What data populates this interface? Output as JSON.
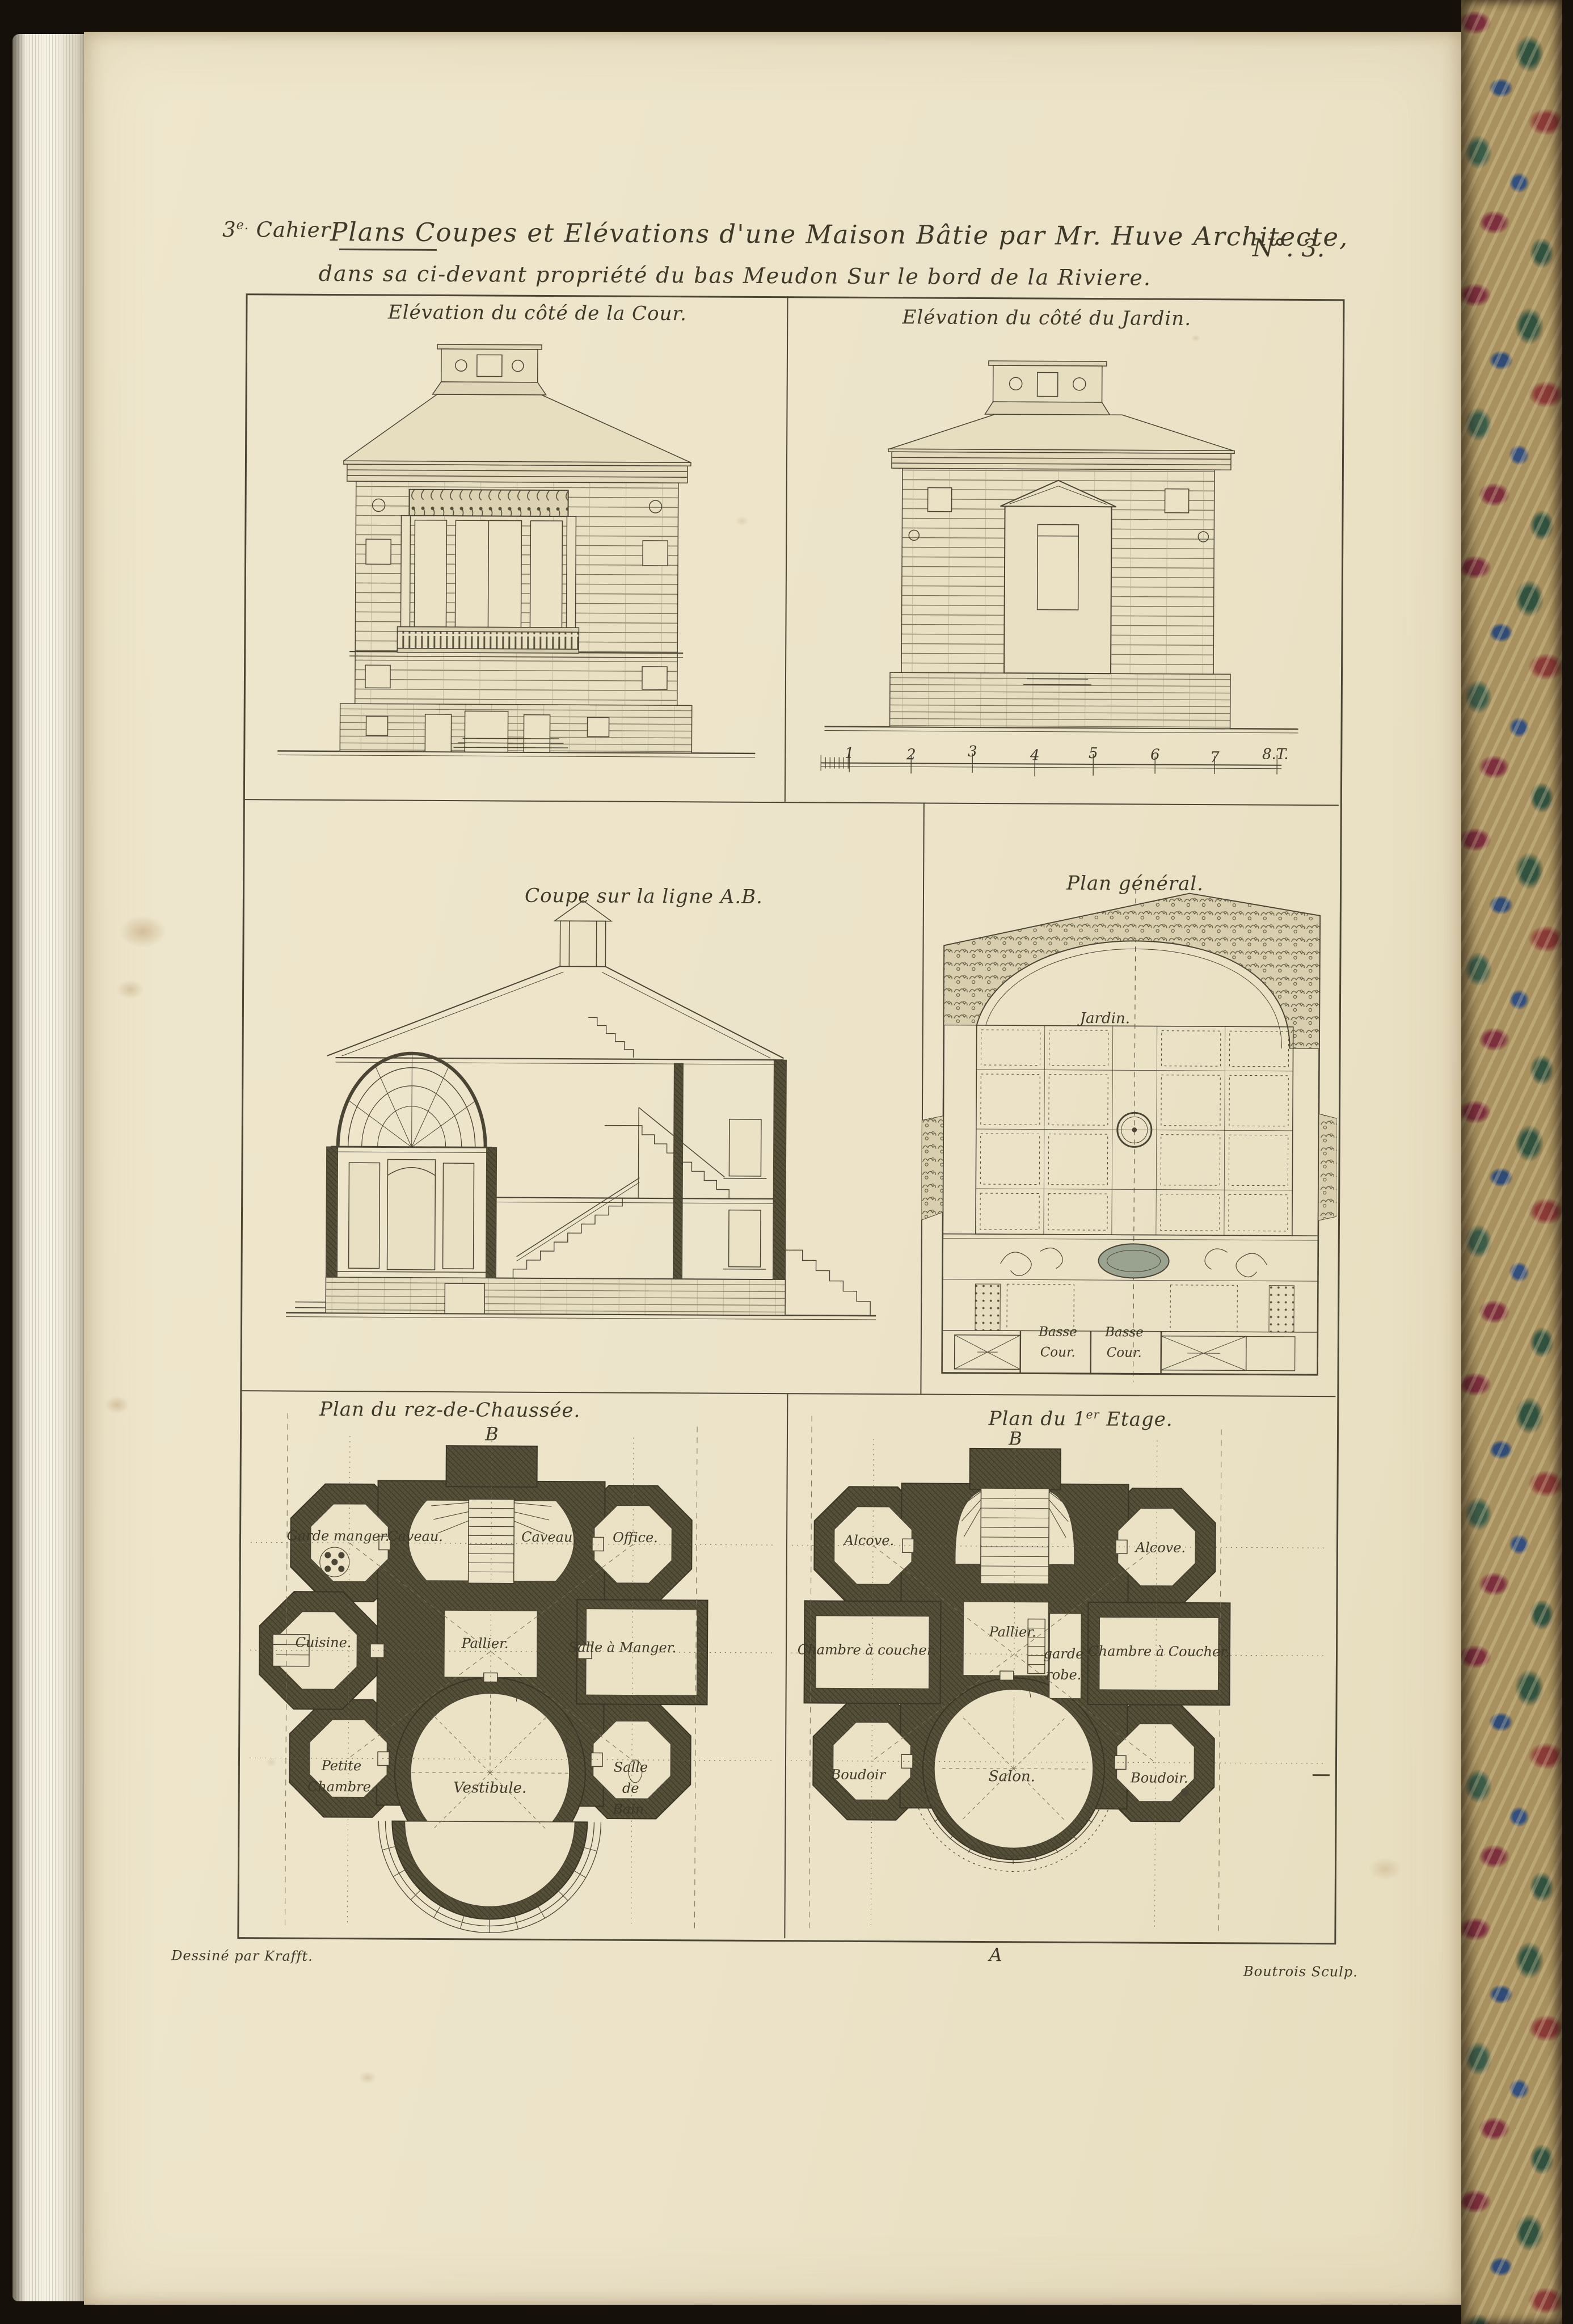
{
  "plate": {
    "header": {
      "cahier_number": "3",
      "cahier_sup": "e.",
      "cahier_word": "Cahier",
      "title_line1": "Plans Coupes et Elévations d'une Maison Bâtie par Mr. Huve Architecte,",
      "title_line2": "dans sa ci-devant propriété du bas Meudon Sur le bord de la Riviere.",
      "plate_number": "N°. 3."
    },
    "panels": {
      "elevation_cour": {
        "title": "Elévation du côté de la Cour."
      },
      "elevation_jardin": {
        "title": "Elévation du côté du Jardin.",
        "scale_ticks": [
          "1",
          "2",
          "3",
          "4",
          "5",
          "6",
          "7",
          "8.T."
        ]
      },
      "coupe": {
        "title": "Coupe sur la ligne A.B."
      },
      "plan_general": {
        "title": "Plan général.",
        "labels": {
          "garden": "Jardin.",
          "basse_cour_left": "Basse Cour.",
          "basse_cour_right": "Basse Cour."
        }
      },
      "plan_rdc": {
        "title": "Plan du rez-de-Chaussée.",
        "marker_top": "B",
        "rooms": {
          "garde_manger": "Garde manger.",
          "caveau_left": "Caveau.",
          "caveau_right": "Caveau.",
          "office": "Office.",
          "cuisine": "Cuisine.",
          "pallier": "Pallier.",
          "salle_a_manger": "Salle à Manger.",
          "petite_chambre": "Petite Chambre.",
          "vestibule": "Vestibule.",
          "salle_de_bain": "Salle de Bain."
        }
      },
      "plan_etage": {
        "title_prefix": "Plan du 1",
        "title_sup": "er",
        "title_suffix": " Etage.",
        "marker_top": "B",
        "marker_bottom": "A",
        "rooms": {
          "alcove_left": "Alcove.",
          "alcove_right": "Alcove.",
          "pallier": "Pallier.",
          "chambre_left": "Chambre à coucher.",
          "garde_robe": "garde robe.",
          "chambre_right": "Chambre à Coucher.",
          "boudoir_left": "Boudoir",
          "salon": "Salon.",
          "boudoir_right": "Boudoir."
        }
      }
    },
    "credits": {
      "drawn_by": "Dessiné par Krafft.",
      "engraved_by": "Boutrois Sculp."
    },
    "colors": {
      "paper": "#ece3c9",
      "ink": "#44402f",
      "poche": "#54503a",
      "marble_base": "#a9915f",
      "pond": "#9aa390"
    }
  }
}
